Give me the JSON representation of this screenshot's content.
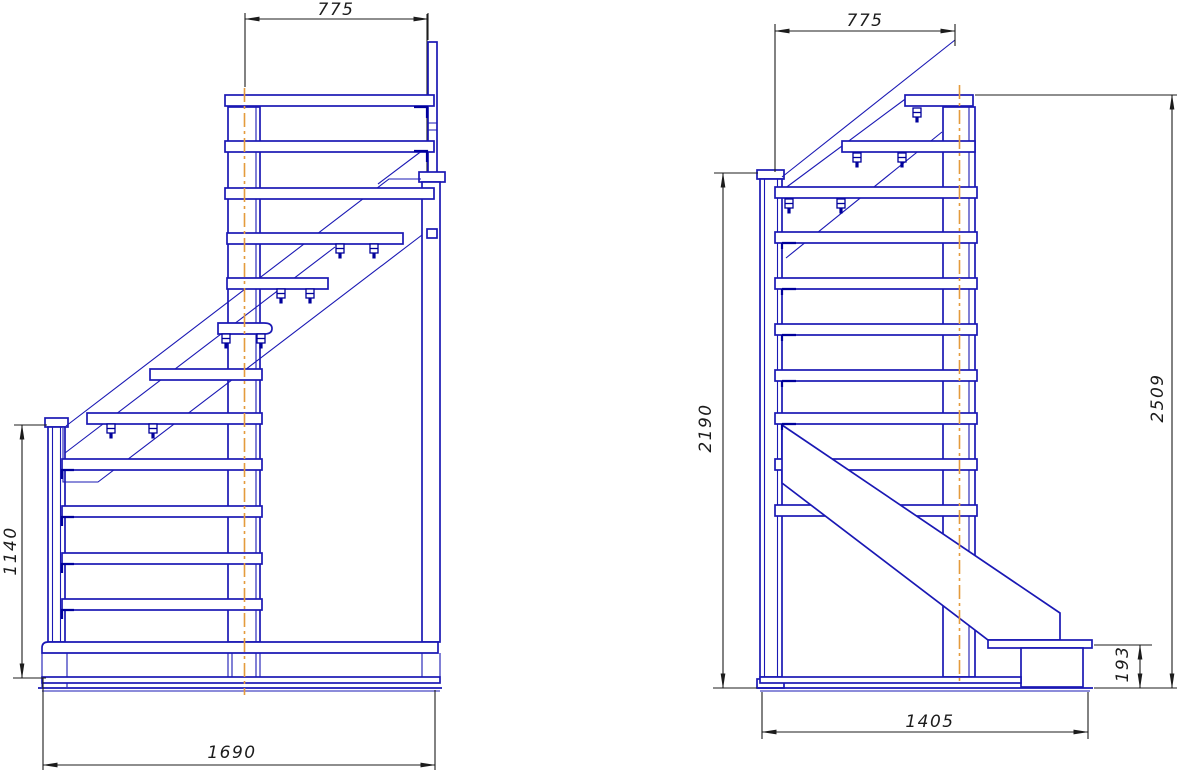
{
  "drawing": {
    "colors": {
      "line": "#1a18b4",
      "detail": "#00009b",
      "centerline": "#e49b3c",
      "dimension": "#1c1c1c",
      "background": "#ffffff"
    },
    "views": {
      "left": {
        "dimensions": {
          "top_width": "775",
          "left_height": "1140",
          "bottom_width": "1690"
        }
      },
      "right": {
        "dimensions": {
          "top_width": "775",
          "left_height": "2190",
          "right_height": "2509",
          "step_height": "193",
          "bottom_width": "1405"
        }
      }
    }
  }
}
